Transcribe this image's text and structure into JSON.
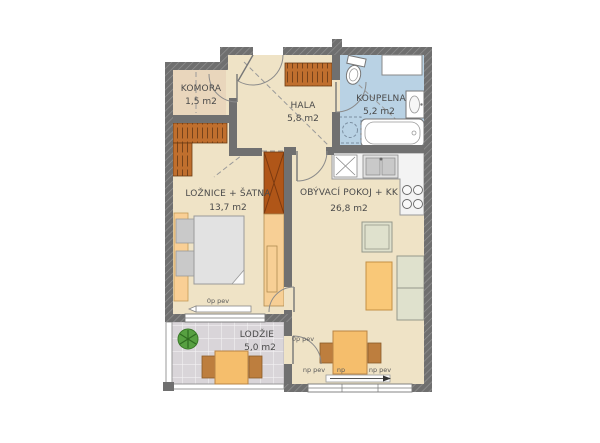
{
  "plan_title": "apartment-floor-plan",
  "rooms": [
    {
      "id": "komora",
      "name": "KOMORA",
      "area": "1,5 m2"
    },
    {
      "id": "hala",
      "name": "HALA",
      "area": "5,8 m2"
    },
    {
      "id": "koupelna",
      "name": "KOUPELNA",
      "area": "5,2 m2"
    },
    {
      "id": "loznice",
      "name": "LOŽNICE + ŠATNA",
      "area": "13,7 m2"
    },
    {
      "id": "obyvaci",
      "name": "OBÝVACÍ POKOJ + KK",
      "area": "26,8 m2"
    },
    {
      "id": "lodzie",
      "name": "LODŽIE",
      "area": "5,0 m2"
    }
  ],
  "window_labels": {
    "bedroom_window": "0p pev",
    "living_loggia_door": "0p pev",
    "living_window_left": "np pev",
    "living_window_mid": "np",
    "living_window_right": "np pev"
  },
  "colors": {
    "wall": "#707070",
    "floor": "#efe3c6",
    "floor_komora": "#e9d6bc",
    "bathroom_floor": "#b9d2e4",
    "loggia_floor": "#d9d5d9",
    "wardrobe_orange": "#c06f2e",
    "wardrobe_dark": "#b05618",
    "furniture_orange": "#f5be6c",
    "furniture_sage": "#dfe1cd",
    "bed_gray": "#e2e2e2",
    "plant_green": "#57a041",
    "text": "#4a4a4a"
  }
}
